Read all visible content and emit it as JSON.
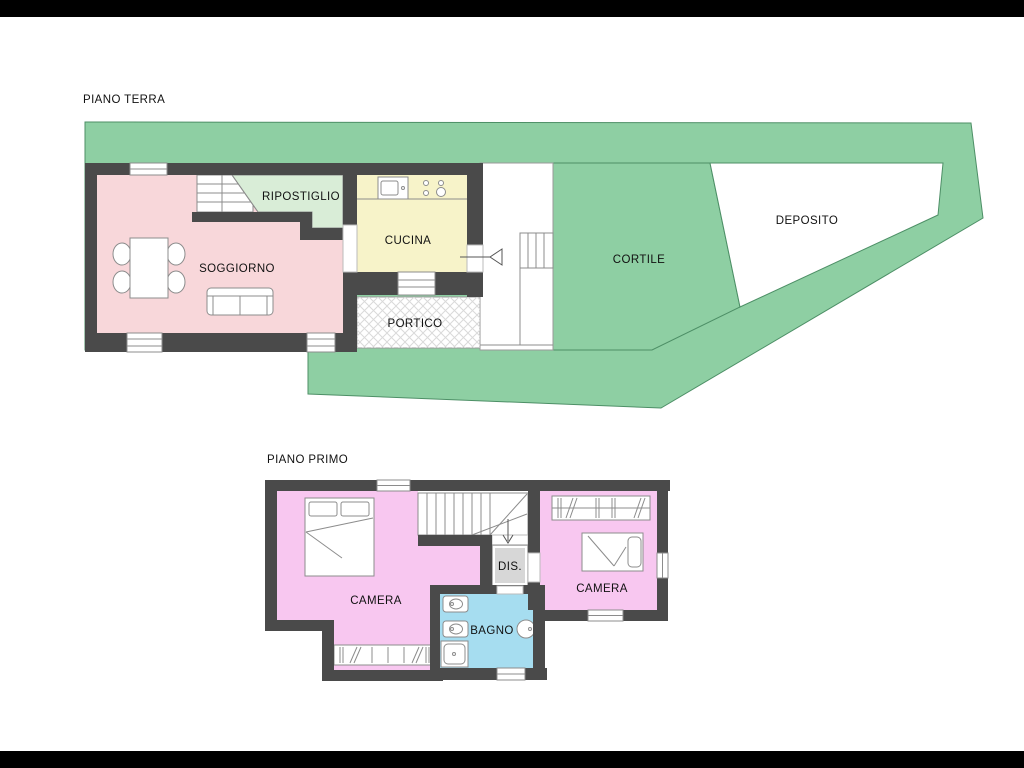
{
  "page": {
    "background": "#ffffff",
    "letterbox_color": "#000000"
  },
  "palette": {
    "wall": "#4a4a4a",
    "terrain_green": "#8ecfa3",
    "terrain_border": "#4d8f66",
    "soggiorno_pink": "#f8d7da",
    "ripostiglio_green": "#d9edd7",
    "cucina_yellow": "#f7f3c9",
    "camera_pink": "#f8c7f0",
    "bagno_blue": "#a6ddf0",
    "dis_gray": "#d7d7d7",
    "deposito_white": "#ffffff",
    "corridor_white": "#ffffff",
    "line_gray": "#8c8c8c"
  },
  "ground_floor": {
    "title": "PIANO TERRA",
    "rooms": {
      "soggiorno": {
        "label": "SOGGIORNO"
      },
      "ripostiglio": {
        "label": "RIPOSTIGLIO"
      },
      "cucina": {
        "label": "CUCINA"
      },
      "portico": {
        "label": "PORTICO"
      },
      "cortile": {
        "label": "CORTILE"
      },
      "deposito": {
        "label": "DEPOSITO"
      }
    }
  },
  "first_floor": {
    "title": "PIANO PRIMO",
    "rooms": {
      "camera1": {
        "label": "CAMERA"
      },
      "disimpegno": {
        "label": "DIS."
      },
      "camera2": {
        "label": "CAMERA"
      },
      "bagno": {
        "label": "BAGNO"
      }
    }
  }
}
